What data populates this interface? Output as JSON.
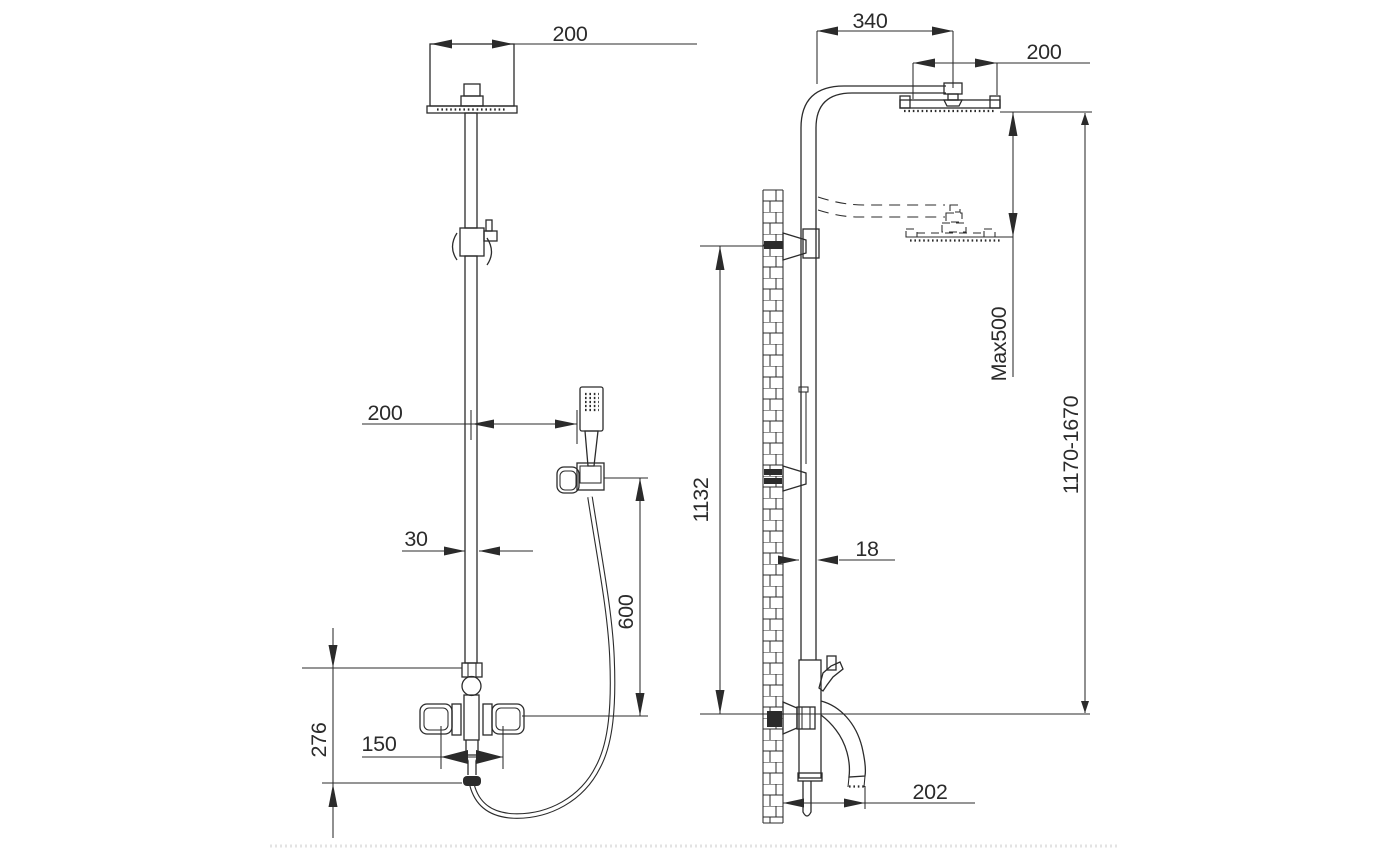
{
  "dims": {
    "front_head_width": "200",
    "front_handshower_offset": "200",
    "front_column_width": "30",
    "front_hose_height": "600",
    "front_spout_height": "276",
    "front_handle_span": "150",
    "side_arm_length": "340",
    "side_head_depth": "200",
    "side_max_adjust": "Max500",
    "side_total_height": "1170-1670",
    "side_wall_height": "1132",
    "side_pipe_depth": "18",
    "side_spout_reach": "202"
  },
  "colors": {
    "line": "#2b2b2b",
    "background": "#ffffff"
  }
}
